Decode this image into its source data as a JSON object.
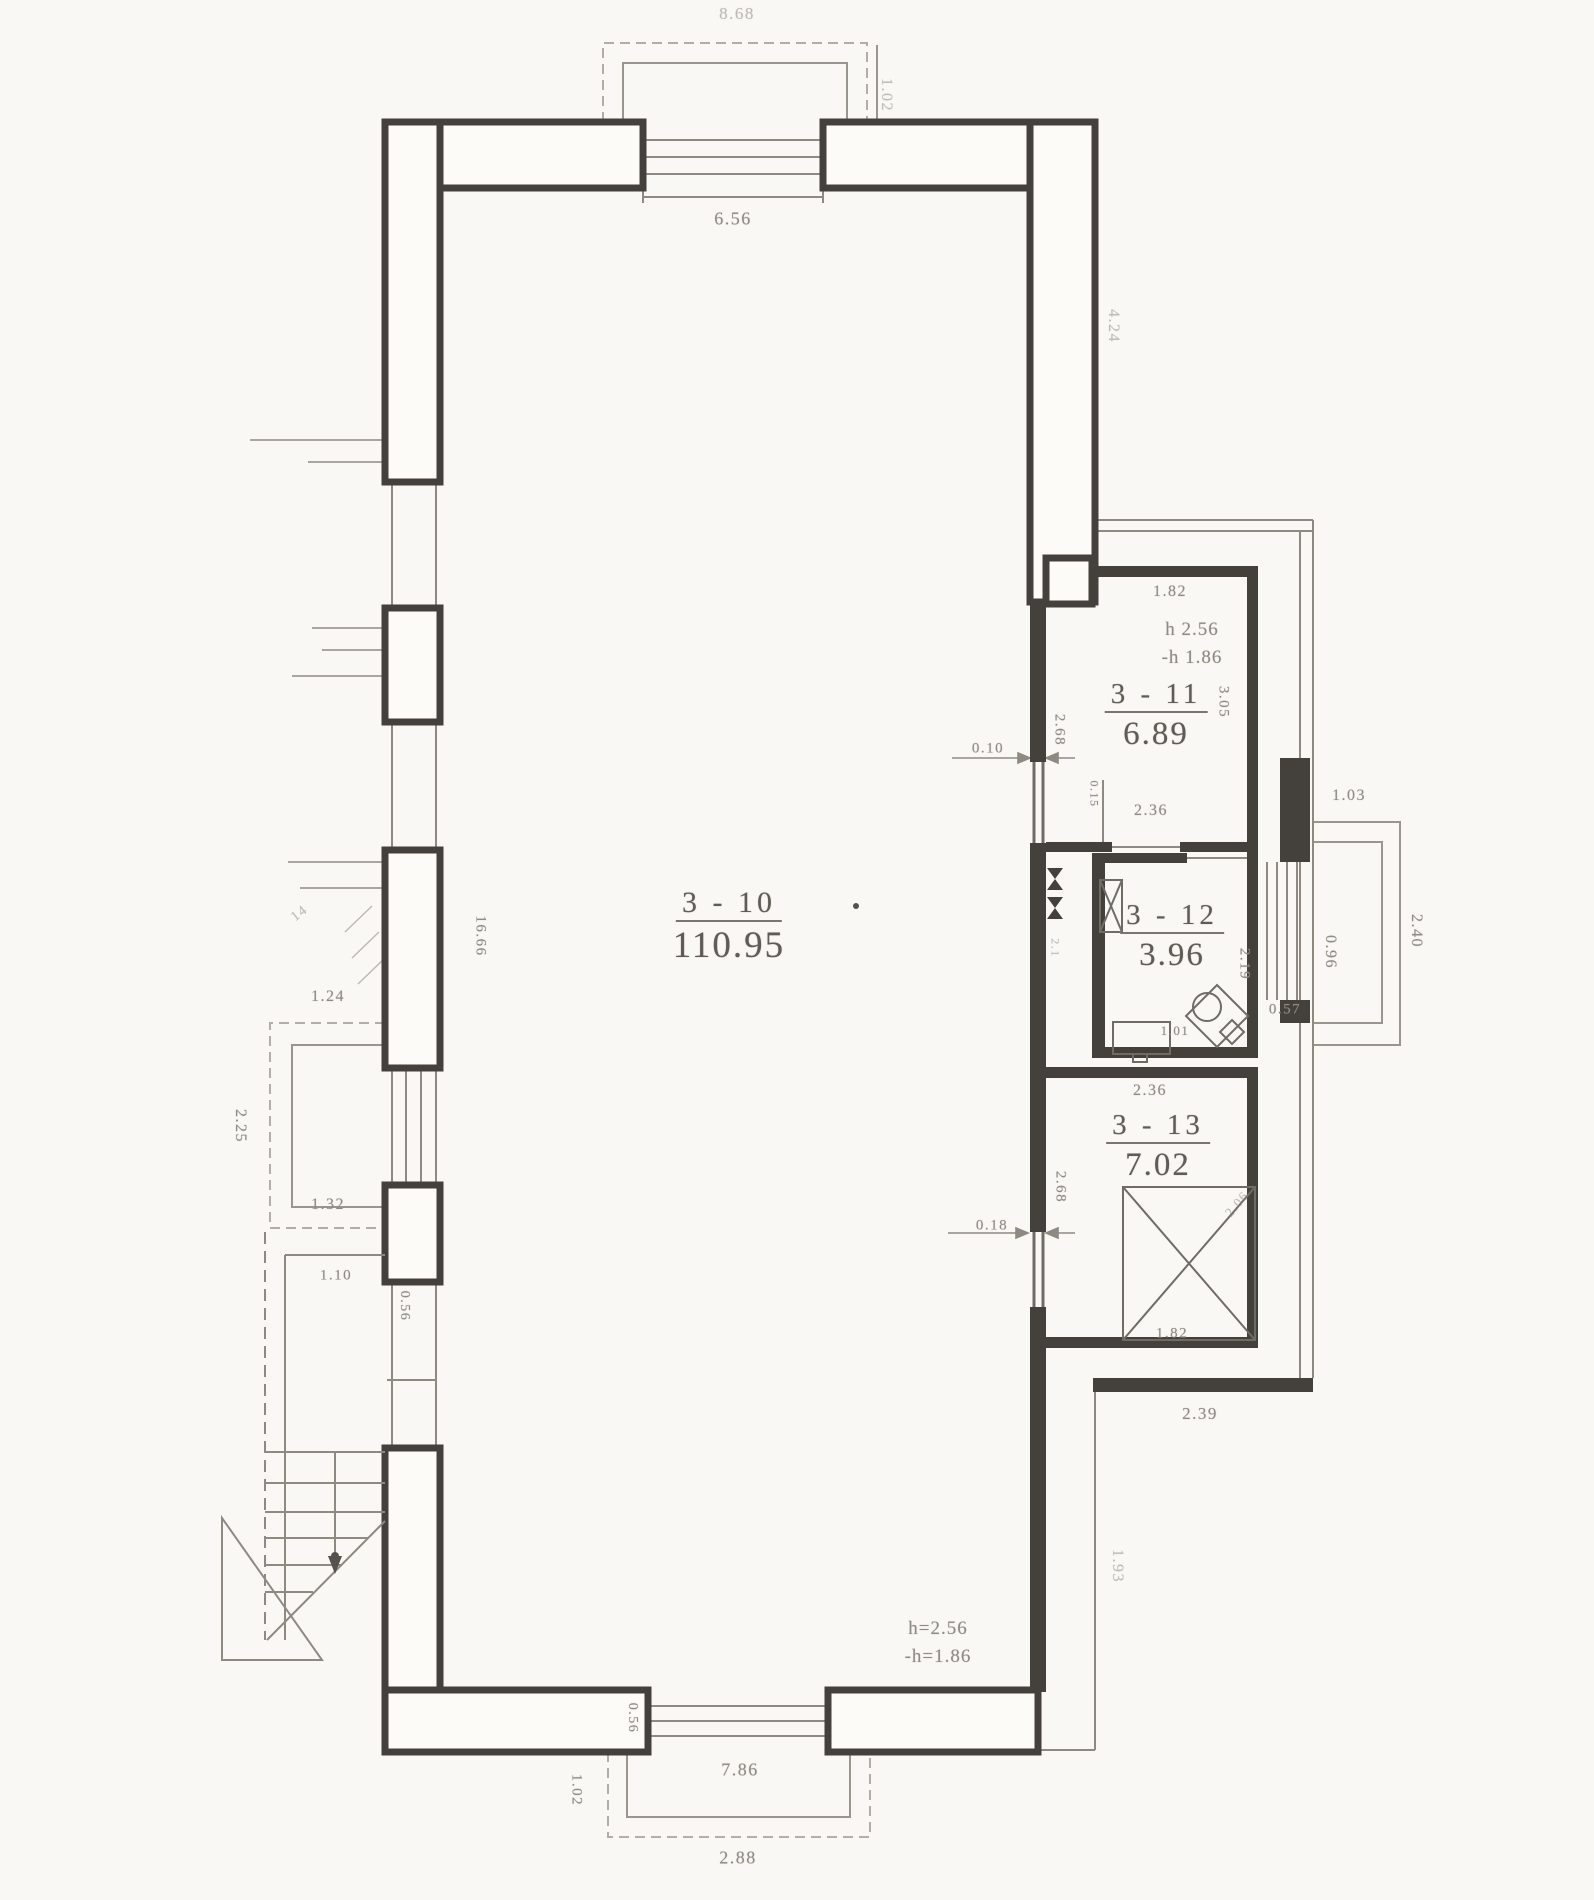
{
  "drawing_type": "floor-plan",
  "colors": {
    "paper": "#f9f8f5",
    "wall_dark": "#44413d",
    "thin_line": "#8e8a82",
    "faint_line": "#b2aea5",
    "dimension_text": "#8f8b83",
    "room_text": "#605c55"
  },
  "rooms": [
    {
      "id": "3-10",
      "number": "3 - 10",
      "area": "110.95",
      "x": 729,
      "y": 888,
      "num_size": 30,
      "area_size": 37
    },
    {
      "id": "3-11",
      "number": "3 - 11",
      "area": "6.89",
      "x": 1156,
      "y": 680,
      "num_size": 29,
      "area_size": 33
    },
    {
      "id": "3-12",
      "number": "3 - 12",
      "area": "3.96",
      "x": 1172,
      "y": 901,
      "num_size": 29,
      "area_size": 33
    },
    {
      "id": "3-13",
      "number": "3 - 13",
      "area": "7.02",
      "x": 1158,
      "y": 1111,
      "num_size": 29,
      "area_size": 33
    }
  ],
  "height_notes": [
    {
      "line1": "h 2.56",
      "line2": "-h 1.86",
      "x": 1192,
      "y": 616,
      "size": 19
    },
    {
      "line1": "h=2.56",
      "line2": "-h=1.86",
      "x": 938,
      "y": 1615,
      "size": 19
    }
  ],
  "dimensions": [
    {
      "t": "8.68",
      "x": 737,
      "y": 14,
      "r": 0,
      "s": 17,
      "faint": true
    },
    {
      "t": "1.02",
      "x": 886,
      "y": 95,
      "r": 90,
      "s": 16,
      "faint": true
    },
    {
      "t": "6.56",
      "x": 733,
      "y": 219,
      "r": 0,
      "s": 18,
      "faint": false
    },
    {
      "t": "4.24",
      "x": 1113,
      "y": 326,
      "r": 90,
      "s": 16,
      "faint": true
    },
    {
      "t": "1.82",
      "x": 1170,
      "y": 592,
      "r": 0,
      "s": 16,
      "faint": false
    },
    {
      "t": "2.68",
      "x": 1059,
      "y": 730,
      "r": 90,
      "s": 15,
      "faint": false
    },
    {
      "t": "3.05",
      "x": 1223,
      "y": 702,
      "r": 90,
      "s": 15,
      "faint": false
    },
    {
      "t": "0.10",
      "x": 988,
      "y": 749,
      "r": 0,
      "s": 15,
      "faint": false
    },
    {
      "t": "0.15",
      "x": 1094,
      "y": 794,
      "r": 90,
      "s": 12,
      "faint": false
    },
    {
      "t": "2.36",
      "x": 1151,
      "y": 811,
      "r": 0,
      "s": 16,
      "faint": false
    },
    {
      "t": "1.03",
      "x": 1349,
      "y": 796,
      "r": 0,
      "s": 16,
      "faint": false
    },
    {
      "t": "2.19",
      "x": 1244,
      "y": 964,
      "r": 90,
      "s": 15,
      "faint": false
    },
    {
      "t": "0.96",
      "x": 1330,
      "y": 952,
      "r": 90,
      "s": 16,
      "faint": false
    },
    {
      "t": "2.40",
      "x": 1416,
      "y": 931,
      "r": 90,
      "s": 16,
      "faint": false
    },
    {
      "t": "0.57",
      "x": 1285,
      "y": 1010,
      "r": 0,
      "s": 15,
      "faint": false
    },
    {
      "t": "1.01",
      "x": 1175,
      "y": 1031,
      "r": 0,
      "s": 13,
      "faint": false
    },
    {
      "t": "2.1",
      "x": 1055,
      "y": 948,
      "r": 90,
      "s": 12,
      "faint": true
    },
    {
      "t": "2.36",
      "x": 1150,
      "y": 1091,
      "r": 0,
      "s": 16,
      "faint": false
    },
    {
      "t": "2.68",
      "x": 1060,
      "y": 1187,
      "r": 90,
      "s": 15,
      "faint": false
    },
    {
      "t": "0.18",
      "x": 992,
      "y": 1226,
      "r": 0,
      "s": 15,
      "faint": false
    },
    {
      "t": "1.82",
      "x": 1172,
      "y": 1334,
      "r": 0,
      "s": 15,
      "faint": false
    },
    {
      "t": "2.06",
      "x": 1237,
      "y": 1204,
      "r": -50,
      "s": 13,
      "faint": true
    },
    {
      "t": "2.39",
      "x": 1200,
      "y": 1414,
      "r": 0,
      "s": 17,
      "faint": false
    },
    {
      "t": "1.93",
      "x": 1117,
      "y": 1566,
      "r": 90,
      "s": 16,
      "faint": true
    },
    {
      "t": "16.66",
      "x": 480,
      "y": 936,
      "r": 90,
      "s": 15,
      "faint": false
    },
    {
      "t": "1.24",
      "x": 328,
      "y": 997,
      "r": 0,
      "s": 16,
      "faint": false
    },
    {
      "t": "2.25",
      "x": 240,
      "y": 1126,
      "r": 90,
      "s": 16,
      "faint": false
    },
    {
      "t": "1.32",
      "x": 328,
      "y": 1205,
      "r": 0,
      "s": 16,
      "faint": false
    },
    {
      "t": "1.10",
      "x": 336,
      "y": 1276,
      "r": 0,
      "s": 15,
      "faint": false
    },
    {
      "t": "0.56",
      "x": 404,
      "y": 1306,
      "r": 90,
      "s": 14,
      "faint": false
    },
    {
      "t": "14",
      "x": 300,
      "y": 914,
      "r": -38,
      "s": 14,
      "faint": true
    },
    {
      "t": "0.56",
      "x": 632,
      "y": 1718,
      "r": 90,
      "s": 14,
      "faint": false
    },
    {
      "t": "7.86",
      "x": 740,
      "y": 1770,
      "r": 0,
      "s": 18,
      "faint": false
    },
    {
      "t": "1.02",
      "x": 576,
      "y": 1790,
      "r": 90,
      "s": 15,
      "faint": false
    },
    {
      "t": "2.88",
      "x": 738,
      "y": 1858,
      "r": 0,
      "s": 18,
      "faint": false
    }
  ]
}
